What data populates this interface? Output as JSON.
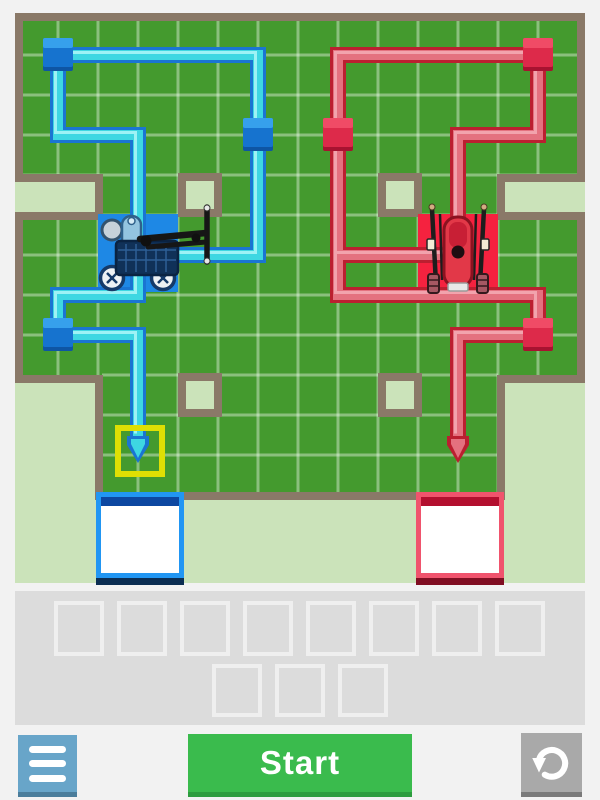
{
  "screen": {
    "width": 600,
    "height": 800,
    "bg": "#f2f2f2"
  },
  "board": {
    "x": 15,
    "y": 13,
    "w": 570,
    "h": 570,
    "colors": {
      "green": "#449a2e",
      "pale": "#cbe3ba",
      "wall": "#8a7968",
      "grid": "rgba(255,255,255,0.38)"
    },
    "green_rects": [
      [
        22,
        20,
        556,
        357
      ],
      [
        102,
        375,
        396,
        119
      ]
    ],
    "grid": {
      "v_xs": [
        58,
        98,
        138,
        178,
        218,
        258,
        298,
        338,
        378,
        418,
        458,
        498,
        538
      ],
      "h_ys": [
        55,
        95,
        135,
        175,
        215,
        255,
        295,
        335,
        375,
        415,
        455
      ],
      "v_top": 20,
      "v_bottom_side": 377,
      "v_bottom_mid": 494,
      "mid_min": 102,
      "mid_max": 498,
      "h_left": 22,
      "h_right": 578,
      "h_left_low": 102,
      "h_right_low": 498,
      "low_from": 375
    },
    "notches": [
      [
        15,
        182,
        82,
        31
      ],
      [
        503,
        182,
        82,
        31
      ]
    ],
    "obstacles": {
      "size": 44,
      "inset": 8,
      "cells": [
        [
          178,
          173
        ],
        [
          378,
          173
        ],
        [
          178,
          373
        ],
        [
          378,
          373
        ]
      ]
    },
    "walls": [
      [
        15,
        13,
        570,
        8
      ],
      [
        15,
        13,
        8,
        161
      ],
      [
        577,
        13,
        8,
        161
      ],
      [
        15,
        174,
        88,
        8
      ],
      [
        95,
        174,
        8,
        46
      ],
      [
        15,
        212,
        88,
        8
      ],
      [
        497,
        174,
        88,
        8
      ],
      [
        497,
        174,
        8,
        46
      ],
      [
        497,
        212,
        88,
        8
      ],
      [
        15,
        212,
        8,
        171
      ],
      [
        577,
        212,
        8,
        171
      ],
      [
        15,
        375,
        88,
        8
      ],
      [
        497,
        375,
        88,
        8
      ],
      [
        95,
        375,
        8,
        125
      ],
      [
        497,
        375,
        8,
        125
      ],
      [
        95,
        492,
        410,
        8
      ]
    ]
  },
  "trails": {
    "stroke_border": 16,
    "stroke_fill": 10,
    "stroke_hl": 3,
    "blue": {
      "border": "#1a75d2",
      "fill": "#3ed7e2",
      "highlight": "#9df2f5",
      "node_front": "#1673cf",
      "node_top": "#36a0ec",
      "node_dark": "#0e55a4",
      "chains": [
        [
          [
            58,
            55
          ],
          [
            258,
            55
          ],
          [
            258,
            255
          ],
          [
            140,
            255
          ]
        ],
        [
          [
            58,
            55
          ],
          [
            58,
            135
          ],
          [
            138,
            135
          ],
          [
            138,
            248
          ]
        ],
        [
          [
            138,
            255
          ],
          [
            138,
            295
          ],
          [
            58,
            295
          ],
          [
            58,
            335
          ],
          [
            138,
            335
          ],
          [
            138,
            436
          ]
        ]
      ],
      "nodes": [
        [
          58,
          55
        ],
        [
          258,
          135
        ],
        [
          58,
          335
        ]
      ],
      "arrow": [
        138,
        436
      ]
    },
    "red": {
      "border": "#bb1f30",
      "fill": "#e4717f",
      "highlight": "#f2a3ad",
      "node_front": "#dd2a4a",
      "node_top": "#f04b66",
      "node_dark": "#a81230",
      "chains": [
        [
          [
            538,
            55
          ],
          [
            338,
            55
          ],
          [
            338,
            295
          ],
          [
            538,
            295
          ],
          [
            538,
            335
          ],
          [
            458,
            335
          ],
          [
            458,
            436
          ]
        ],
        [
          [
            538,
            55
          ],
          [
            538,
            135
          ],
          [
            458,
            135
          ],
          [
            458,
            248
          ]
        ],
        [
          [
            338,
            255
          ],
          [
            450,
            255
          ]
        ]
      ],
      "nodes": [
        [
          538,
          55
        ],
        [
          338,
          135
        ],
        [
          538,
          335
        ]
      ],
      "arrow": [
        458,
        436
      ]
    }
  },
  "robots": [
    {
      "kind": "blue-rover",
      "tile": [
        98,
        214,
        80,
        78
      ],
      "tile_color": "#1e88e5",
      "cx": 138,
      "cy": 252
    },
    {
      "kind": "red-bike",
      "tile": [
        418,
        214,
        80,
        78
      ],
      "tile_color": "#f5223f",
      "cx": 458,
      "cy": 252
    }
  ],
  "highlight": {
    "x": 115,
    "y": 425,
    "w": 50,
    "h": 52,
    "color": "#dfdf04",
    "stroke": 6
  },
  "goals": [
    {
      "name": "blue-goal",
      "x": 96,
      "y": 492,
      "w": 88,
      "h": 86,
      "border": "#2196f3",
      "top_bar": "#0d47a1",
      "shadow": "#0b2d52",
      "fill": "#ffffff"
    },
    {
      "name": "red-goal",
      "x": 416,
      "y": 492,
      "w": 88,
      "h": 86,
      "border": "#f0536d",
      "top_bar": "#b30f2f",
      "shadow": "#800e22",
      "fill": "#ffffff"
    }
  ],
  "tray": {
    "x": 15,
    "y": 591,
    "w": 570,
    "h": 134,
    "bg": "#dcdcdc",
    "slot_border": "#efefef",
    "rows": [
      {
        "count": 8,
        "x0": 54,
        "y": 601,
        "w": 50,
        "h": 55,
        "pitch": 63
      },
      {
        "count": 3,
        "x0": 212,
        "y": 664,
        "w": 50,
        "h": 53,
        "pitch": 63
      }
    ]
  },
  "controls": {
    "menu": {
      "bg": "#68a5c9",
      "edge": "#4b7d9b",
      "icon": "hamburger-icon"
    },
    "start": {
      "bg": "#3abb4d",
      "edge": "#2d9c3f",
      "label": "Start"
    },
    "reset": {
      "bg": "#a9a9a9",
      "edge": "#7a7a7a",
      "icon": "rotate-ccw-icon"
    }
  }
}
